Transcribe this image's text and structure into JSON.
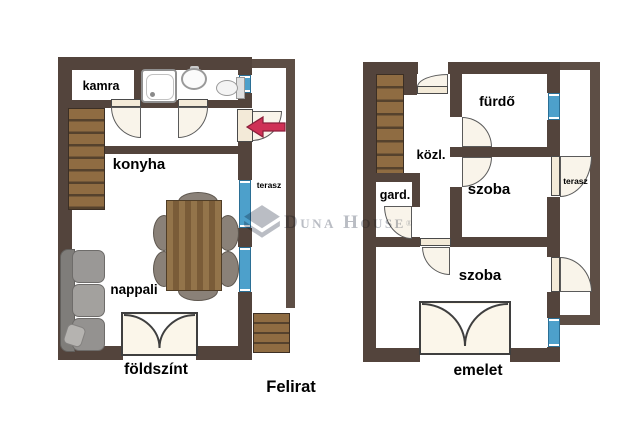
{
  "caption": "Felirat",
  "watermark": {
    "brand": "Duna House",
    "registered": "®"
  },
  "ground_floor": {
    "name": "földszínt",
    "kamra": "kamra",
    "konyha": "konyha",
    "nappali": "nappali",
    "terasz": "terasz"
  },
  "upper_floor": {
    "name": "emelet",
    "furdo": "fürdő",
    "kozl": "közl.",
    "gard": "gard.",
    "szoba_middle": "szoba",
    "szoba_lower": "szoba",
    "terasz": "terasz"
  },
  "colors": {
    "wall": "#53443c",
    "stairs": "#8f6c42",
    "stairs_line": "#55422d",
    "window": "#4da0cb",
    "door": "#f3ead8",
    "door_fill": "#f9f4ea",
    "arrow": "#cf3156",
    "watermark": "#b6bac1"
  }
}
